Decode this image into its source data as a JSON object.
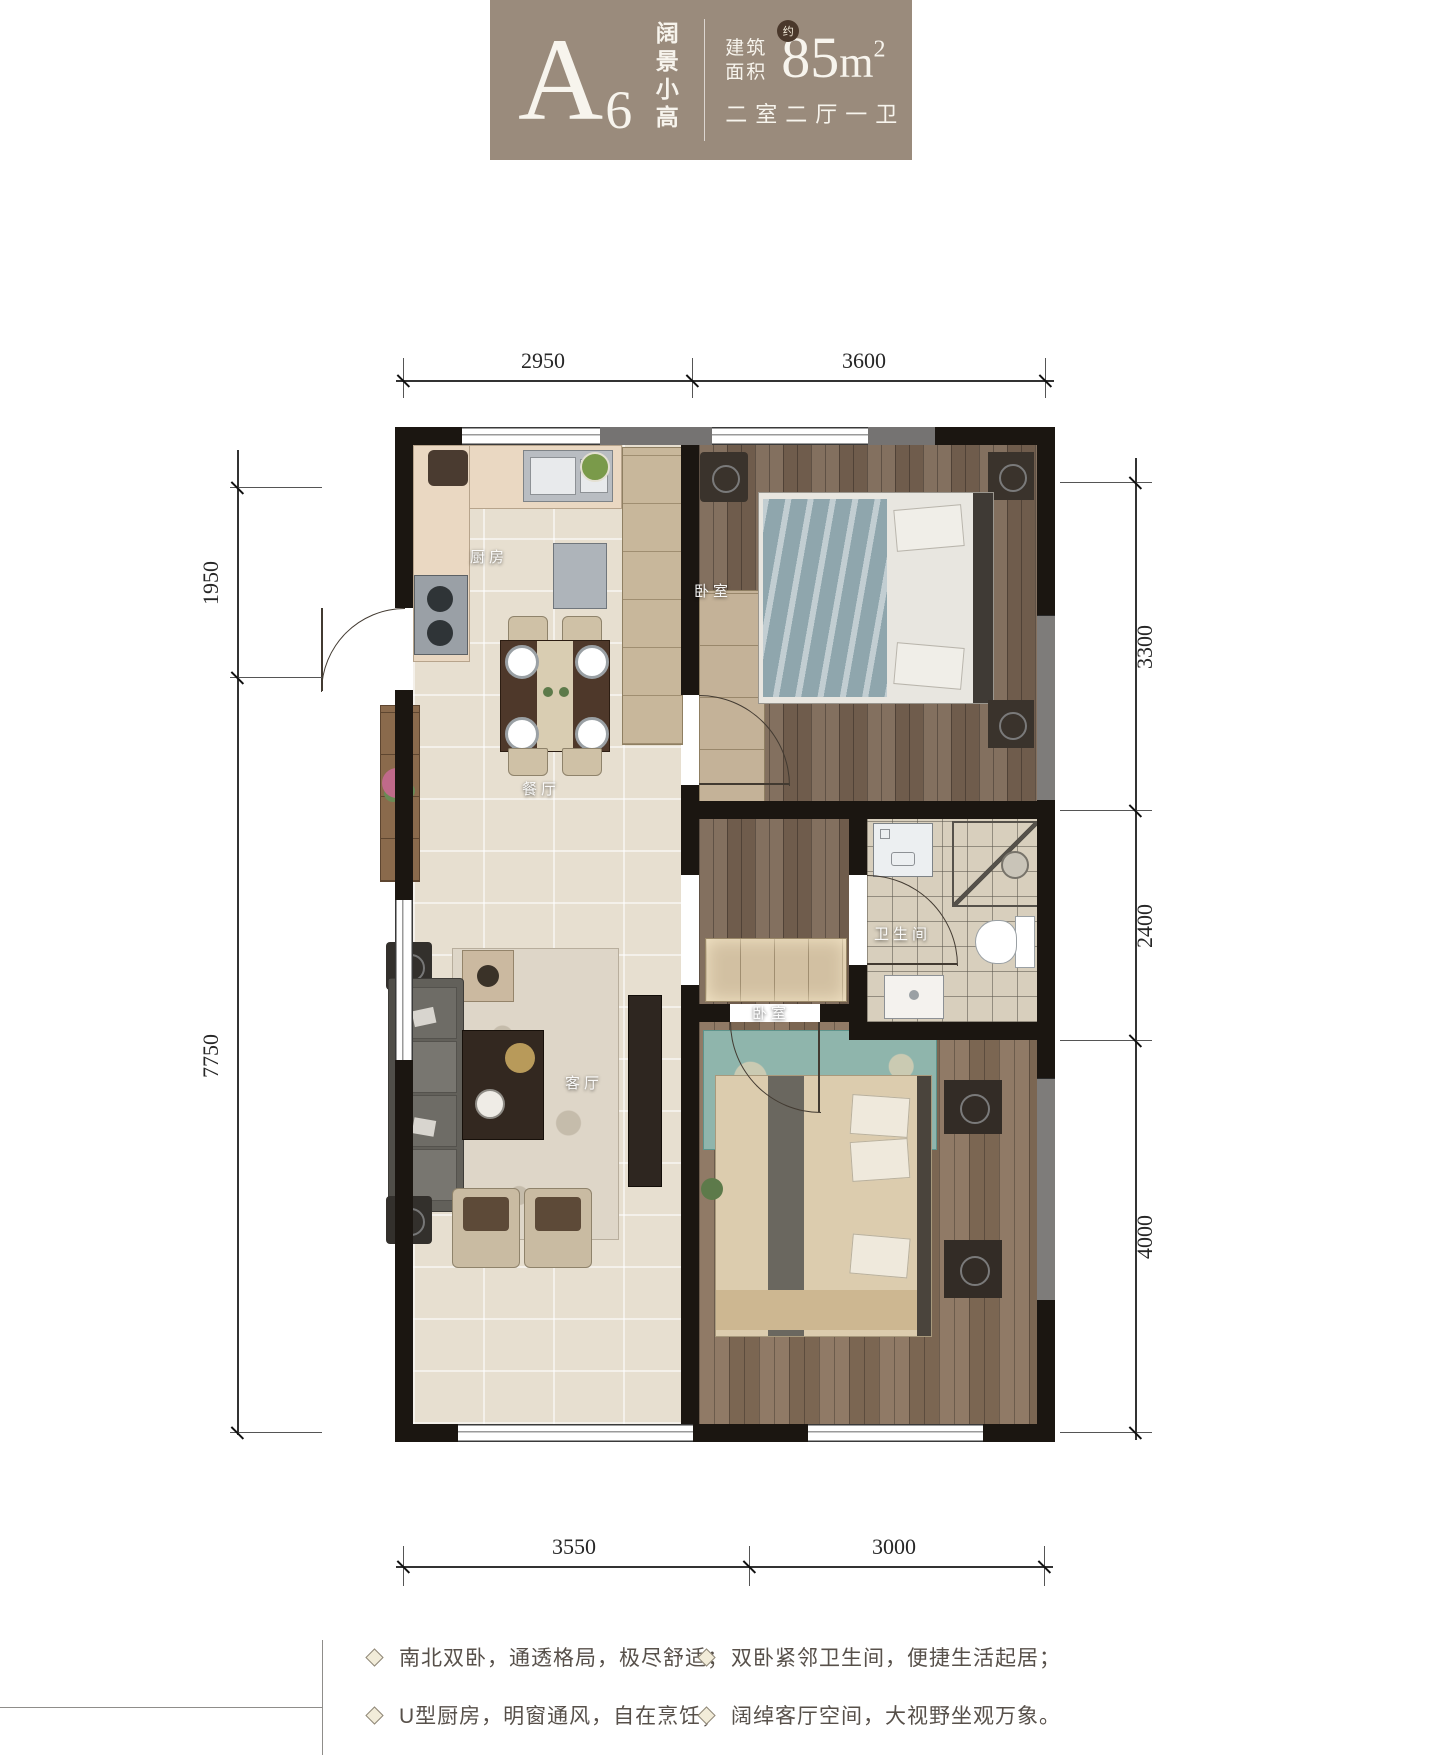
{
  "header": {
    "unit": "A",
    "unit_sub": "6",
    "tagline": "阔景小高",
    "area_label_l1": "建筑",
    "area_label_l2": "面积",
    "approx": "约",
    "area_number": "85",
    "area_unit": "m",
    "area_exp": "2",
    "layout": "二室二厅一卫",
    "colors": {
      "box_bg": "#9a8b7c",
      "badge_bg": "#4a382b",
      "text": "#f7f4ed"
    }
  },
  "rooms": {
    "kitchen": "厨房",
    "bedroom_north": "卧室",
    "dining": "餐厅",
    "bathroom": "卫生间",
    "living": "客厅",
    "bedroom_south": "卧室"
  },
  "dims": {
    "top": [
      "2950",
      "3600"
    ],
    "bottom": [
      "3550",
      "3000"
    ],
    "left": [
      "1950",
      "7750"
    ],
    "right": [
      "3300",
      "2400",
      "4000"
    ]
  },
  "features": {
    "items": [
      "南北双卧，通透格局，极尽舒适；",
      "U型厨房，明窗通风，自在烹饪；",
      "双卧紧邻卫生间，便捷生活起居；",
      "阔绰客厅空间，大视野坐观万象。"
    ]
  },
  "plan_colors": {
    "wall": "#1b1611",
    "tile": "#e7dfd0",
    "wood": "#7d6a5b",
    "bath_tile": "#d8cfbd"
  }
}
